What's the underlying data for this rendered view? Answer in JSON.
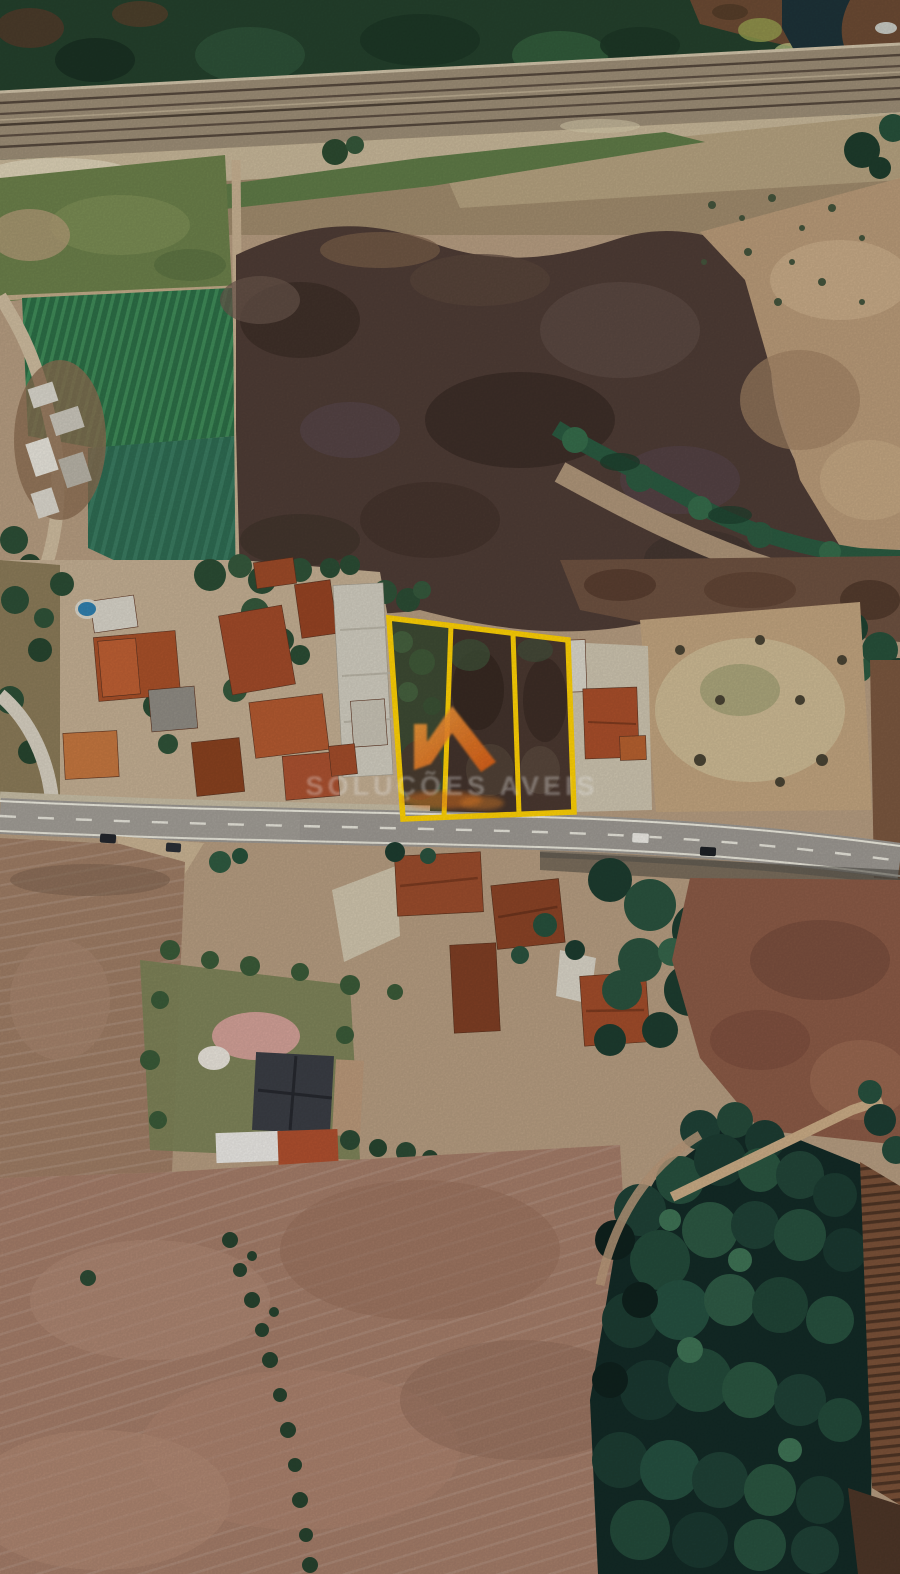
{
  "watermark": {
    "brand_text": "SOLUÇÕES AVEIS",
    "logo_icon": "house-roof-icon",
    "text_color": "#ffffff",
    "logo_color_start": "#f7a23f",
    "logo_color_end": "#e05f15"
  },
  "parcels": {
    "count": 3,
    "outline_color": "#fdd005"
  },
  "scene": {
    "type": "satellite aerial photograph",
    "features": [
      "railway corridor across top",
      "dark stream crossing top right",
      "green crop fields upper left",
      "large dark ploughed burnt field",
      "village strip with terracotta roofs",
      "main road with cars",
      "three land parcels outlined in yellow",
      "plowed pink-brown farmland bottom left",
      "dense forest bottom right",
      "small swimming pool"
    ],
    "colors": {
      "forest": "#1c3c32",
      "burnt_field": "#4e3c35",
      "dry_field": "#b89a78",
      "plowed_field": "#a37c68",
      "crop_green": "#2c6e46",
      "road": "#9c9892",
      "terracotta_roof": "#a84e2a",
      "river": "#1d3238"
    }
  }
}
